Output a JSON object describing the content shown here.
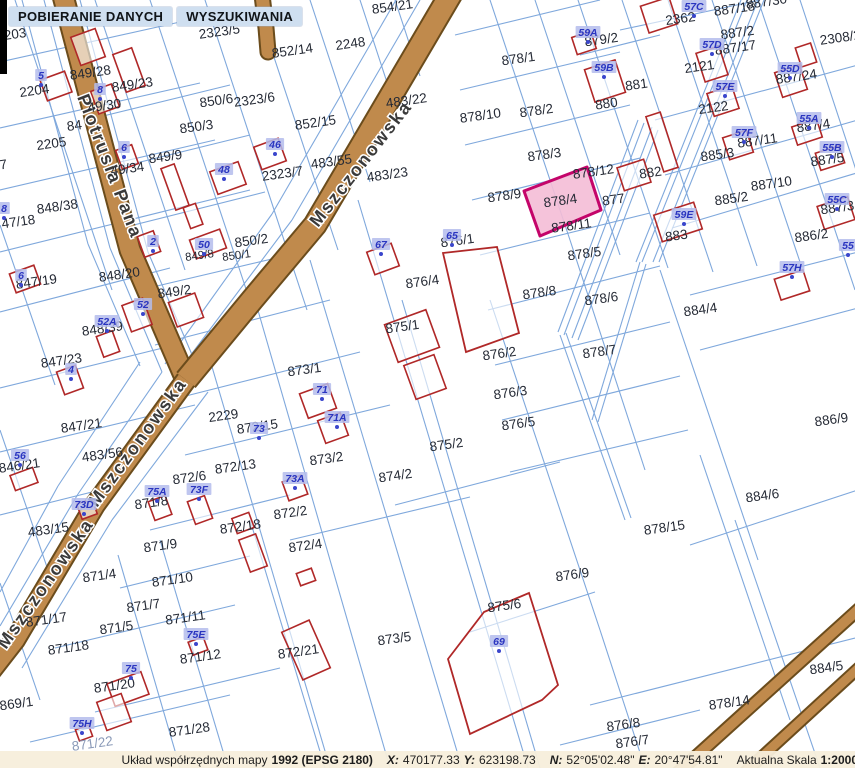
{
  "menu": {
    "items": [
      {
        "label": "POBIERANIE DANYCH"
      },
      {
        "label": "WYSZUKIWANIA"
      }
    ]
  },
  "statusbar": {
    "prefix": "Układ współrzędnych mapy",
    "datum": "1992 (EPSG 2180)",
    "x_label": "X:",
    "x_value": "470177.33",
    "y_label": "Y:",
    "y_value": "623198.73",
    "n_label": "N:",
    "n_value": "52°05'02.48\"",
    "e_label": "E:",
    "e_value": "20°47'54.81\"",
    "scale_label": "Aktualna Skala",
    "scale_value": "1:2000"
  },
  "map": {
    "colors": {
      "boundary": "#7fa8dc",
      "road_fill": "#c08a4c",
      "road_edge": "#6b4c1c",
      "building": "#b02828",
      "highlight_fill": "#f4bcd6",
      "highlight_border": "#c4046a",
      "badge_bg": "#b4bcec",
      "badge_text": "#2a35c0",
      "label": "#252a35",
      "street_label": "#3a3a3a"
    },
    "streets": [
      {
        "name": "Piotrusia Pana",
        "x": 77,
        "y": 97,
        "rot": 69
      },
      {
        "name": "Mszczonowska",
        "x": 318,
        "y": 228,
        "rot": -52
      },
      {
        "name": "Mszczonowska",
        "x": 97,
        "y": 508,
        "rot": -54
      },
      {
        "name": "Mszczonowska",
        "x": 6,
        "y": 650,
        "rot": -55
      }
    ],
    "highlight": {
      "label": "878/4",
      "x": 561,
      "y": 205
    },
    "parcels": [
      {
        "t": "2203",
        "x": 12,
        "y": 39
      },
      {
        "t": "2323/5",
        "x": 220,
        "y": 36
      },
      {
        "t": "854/21",
        "x": 393,
        "y": 11
      },
      {
        "t": "2204",
        "x": 35,
        "y": 95
      },
      {
        "t": "849/28",
        "x": 91,
        "y": 77
      },
      {
        "t": "849/23",
        "x": 133,
        "y": 89
      },
      {
        "t": "49/30",
        "x": 105,
        "y": 110
      },
      {
        "t": "84",
        "x": 75,
        "y": 130
      },
      {
        "t": "2205",
        "x": 52,
        "y": 148
      },
      {
        "t": "850/6",
        "x": 217,
        "y": 105
      },
      {
        "t": "2323/6",
        "x": 255,
        "y": 104
      },
      {
        "t": "850/3",
        "x": 197,
        "y": 131
      },
      {
        "t": "849/9",
        "x": 166,
        "y": 161
      },
      {
        "t": "49/34",
        "x": 128,
        "y": 173
      },
      {
        "t": "2323/7",
        "x": 283,
        "y": 178
      },
      {
        "t": "848/38",
        "x": 58,
        "y": 211
      },
      {
        "t": "47/18",
        "x": 19,
        "y": 226
      },
      {
        "t": "7",
        "x": 4,
        "y": 169
      },
      {
        "t": "850/2",
        "x": 252,
        "y": 245
      },
      {
        "t": "850/1",
        "x": 237,
        "y": 259,
        "s": "small"
      },
      {
        "t": "849/8",
        "x": 200,
        "y": 259,
        "s": "small"
      },
      {
        "t": "2248",
        "x": 351,
        "y": 48
      },
      {
        "t": "852/14",
        "x": 293,
        "y": 55
      },
      {
        "t": "852/15",
        "x": 316,
        "y": 127
      },
      {
        "t": "483/55",
        "x": 332,
        "y": 166
      },
      {
        "t": "483/23",
        "x": 388,
        "y": 179
      },
      {
        "t": "483/22",
        "x": 407,
        "y": 105
      },
      {
        "t": "878/1",
        "x": 519,
        "y": 63
      },
      {
        "t": "878/2",
        "x": 537,
        "y": 115
      },
      {
        "t": "878/10",
        "x": 481,
        "y": 120
      },
      {
        "t": "878/3",
        "x": 545,
        "y": 159
      },
      {
        "t": "878/9",
        "x": 505,
        "y": 200
      },
      {
        "t": "878/12",
        "x": 594,
        "y": 176
      },
      {
        "t": "878/11",
        "x": 572,
        "y": 230
      },
      {
        "t": "878/5",
        "x": 585,
        "y": 258
      },
      {
        "t": "878/8",
        "x": 540,
        "y": 297
      },
      {
        "t": "878/6",
        "x": 602,
        "y": 303
      },
      {
        "t": "878/7",
        "x": 600,
        "y": 356
      },
      {
        "t": "877",
        "x": 614,
        "y": 204
      },
      {
        "t": "887/30",
        "x": 767,
        "y": 6
      },
      {
        "t": "887/18",
        "x": 735,
        "y": 13
      },
      {
        "t": "2362",
        "x": 681,
        "y": 23
      },
      {
        "t": "879/2",
        "x": 602,
        "y": 44
      },
      {
        "t": "887/2",
        "x": 738,
        "y": 37
      },
      {
        "t": "887/17",
        "x": 736,
        "y": 52
      },
      {
        "t": "2308/2",
        "x": 841,
        "y": 42
      },
      {
        "t": "2121",
        "x": 700,
        "y": 71
      },
      {
        "t": "887/24",
        "x": 797,
        "y": 81
      },
      {
        "t": "881",
        "x": 637,
        "y": 89
      },
      {
        "t": "880",
        "x": 607,
        "y": 108
      },
      {
        "t": "2122",
        "x": 714,
        "y": 112
      },
      {
        "t": "887/4",
        "x": 814,
        "y": 130
      },
      {
        "t": "887/11",
        "x": 758,
        "y": 145
      },
      {
        "t": "885/3",
        "x": 718,
        "y": 159
      },
      {
        "t": "887/5",
        "x": 828,
        "y": 164
      },
      {
        "t": "882",
        "x": 651,
        "y": 177
      },
      {
        "t": "885/2",
        "x": 732,
        "y": 203
      },
      {
        "t": "887/10",
        "x": 772,
        "y": 188
      },
      {
        "t": "887/3",
        "x": 838,
        "y": 212
      },
      {
        "t": "886/2",
        "x": 812,
        "y": 240
      },
      {
        "t": "883",
        "x": 677,
        "y": 240
      },
      {
        "t": "884/4",
        "x": 701,
        "y": 314
      },
      {
        "t": "886/9",
        "x": 832,
        "y": 424
      },
      {
        "t": "884/6",
        "x": 763,
        "y": 500
      },
      {
        "t": "876/4",
        "x": 423,
        "y": 286
      },
      {
        "t": "876/1",
        "x": 458,
        "y": 245
      },
      {
        "t": "875/1",
        "x": 403,
        "y": 331
      },
      {
        "t": "876/2",
        "x": 500,
        "y": 358
      },
      {
        "t": "876/3",
        "x": 511,
        "y": 397
      },
      {
        "t": "876/5",
        "x": 519,
        "y": 428
      },
      {
        "t": "875/2",
        "x": 447,
        "y": 449
      },
      {
        "t": "874/2",
        "x": 396,
        "y": 480
      },
      {
        "t": "873/2",
        "x": 327,
        "y": 463
      },
      {
        "t": "873/1",
        "x": 305,
        "y": 374
      },
      {
        "t": "872/15",
        "x": 258,
        "y": 431
      },
      {
        "t": "872/13",
        "x": 236,
        "y": 471
      },
      {
        "t": "872/6",
        "x": 190,
        "y": 482
      },
      {
        "t": "871/8",
        "x": 152,
        "y": 507
      },
      {
        "t": "2229",
        "x": 224,
        "y": 420
      },
      {
        "t": "483/56",
        "x": 103,
        "y": 459
      },
      {
        "t": "847/21",
        "x": 82,
        "y": 430
      },
      {
        "t": "847/23",
        "x": 62,
        "y": 365
      },
      {
        "t": "848/39",
        "x": 103,
        "y": 333
      },
      {
        "t": "848/20",
        "x": 120,
        "y": 279
      },
      {
        "t": "849/2",
        "x": 175,
        "y": 296
      },
      {
        "t": "847/19",
        "x": 37,
        "y": 286
      },
      {
        "t": "846/21",
        "x": 20,
        "y": 470
      },
      {
        "t": "483/15",
        "x": 49,
        "y": 534
      },
      {
        "t": "872/18",
        "x": 241,
        "y": 531
      },
      {
        "t": "872/4",
        "x": 306,
        "y": 550
      },
      {
        "t": "872/2",
        "x": 291,
        "y": 517
      },
      {
        "t": "873/5",
        "x": 395,
        "y": 643
      },
      {
        "t": "872/21",
        "x": 299,
        "y": 656
      },
      {
        "t": "875/6",
        "x": 505,
        "y": 610
      },
      {
        "t": "876/9",
        "x": 573,
        "y": 579
      },
      {
        "t": "871/9",
        "x": 161,
        "y": 550
      },
      {
        "t": "871/4",
        "x": 100,
        "y": 580
      },
      {
        "t": "871/10",
        "x": 173,
        "y": 584
      },
      {
        "t": "871/7",
        "x": 144,
        "y": 610
      },
      {
        "t": "871/17",
        "x": 47,
        "y": 624
      },
      {
        "t": "871/11",
        "x": 186,
        "y": 622
      },
      {
        "t": "871/5",
        "x": 117,
        "y": 632
      },
      {
        "t": "871/18",
        "x": 69,
        "y": 652
      },
      {
        "t": "871/12",
        "x": 201,
        "y": 661
      },
      {
        "t": "871/20",
        "x": 115,
        "y": 690
      },
      {
        "t": "869/1",
        "x": 17,
        "y": 708
      },
      {
        "t": "871/28",
        "x": 190,
        "y": 734
      },
      {
        "t": "871/22",
        "x": 93,
        "y": 748,
        "s": "faint"
      },
      {
        "t": "878/15",
        "x": 665,
        "y": 532
      },
      {
        "t": "884/5",
        "x": 827,
        "y": 672
      },
      {
        "t": "878/14",
        "x": 730,
        "y": 707
      },
      {
        "t": "876/8",
        "x": 624,
        "y": 729
      },
      {
        "t": "876/7",
        "x": 633,
        "y": 746
      }
    ],
    "badges": [
      {
        "t": "57C",
        "x": 694,
        "y": 9
      },
      {
        "t": "57D",
        "x": 712,
        "y": 47
      },
      {
        "t": "57E",
        "x": 725,
        "y": 89
      },
      {
        "t": "57F",
        "x": 744,
        "y": 135
      },
      {
        "t": "59A",
        "x": 588,
        "y": 35
      },
      {
        "t": "59B",
        "x": 604,
        "y": 70
      },
      {
        "t": "59E",
        "x": 684,
        "y": 217
      },
      {
        "t": "55D",
        "x": 790,
        "y": 71
      },
      {
        "t": "55A",
        "x": 809,
        "y": 121
      },
      {
        "t": "55B",
        "x": 832,
        "y": 150
      },
      {
        "t": "55C",
        "x": 837,
        "y": 202
      },
      {
        "t": "55",
        "x": 848,
        "y": 248
      },
      {
        "t": "57H",
        "x": 792,
        "y": 270
      },
      {
        "t": "65",
        "x": 452,
        "y": 238
      },
      {
        "t": "67",
        "x": 381,
        "y": 247
      },
      {
        "t": "69",
        "x": 499,
        "y": 644
      },
      {
        "t": "71",
        "x": 322,
        "y": 392
      },
      {
        "t": "71A",
        "x": 337,
        "y": 420
      },
      {
        "t": "73A",
        "x": 295,
        "y": 481
      },
      {
        "t": "75A",
        "x": 157,
        "y": 494
      },
      {
        "t": "73F",
        "x": 199,
        "y": 492
      },
      {
        "t": "73D",
        "x": 84,
        "y": 507
      },
      {
        "t": "75E",
        "x": 196,
        "y": 637
      },
      {
        "t": "75",
        "x": 131,
        "y": 671
      },
      {
        "t": "75H",
        "x": 82,
        "y": 726
      },
      {
        "t": "56",
        "x": 20,
        "y": 458
      },
      {
        "t": "52",
        "x": 143,
        "y": 307
      },
      {
        "t": "52A",
        "x": 107,
        "y": 324
      },
      {
        "t": "46",
        "x": 275,
        "y": 147
      },
      {
        "t": "48",
        "x": 224,
        "y": 172
      },
      {
        "t": "50",
        "x": 204,
        "y": 247
      },
      {
        "t": "2",
        "x": 153,
        "y": 244
      },
      {
        "t": "4",
        "x": 71,
        "y": 372
      },
      {
        "t": "5",
        "x": 41,
        "y": 78
      },
      {
        "t": "6",
        "x": 124,
        "y": 150
      },
      {
        "t": "6",
        "x": 21,
        "y": 278
      },
      {
        "t": "8",
        "x": 100,
        "y": 92
      },
      {
        "t": "8",
        "x": 4,
        "y": 211
      },
      {
        "t": "73",
        "x": 259,
        "y": 431
      }
    ]
  }
}
